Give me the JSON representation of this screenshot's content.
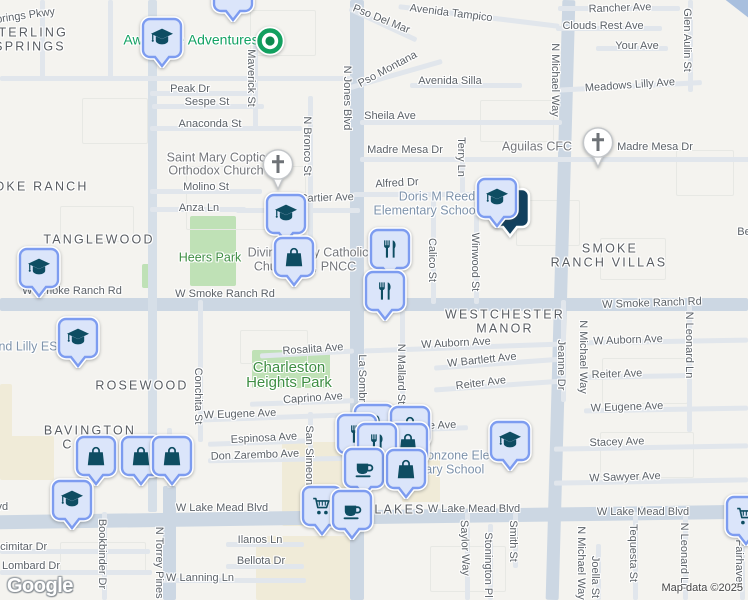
{
  "attribution": "Map data ©2025",
  "logo_text": "Google",
  "colors": {
    "background": "#f4f3ef",
    "major_road": "#ccd7e3",
    "minor_road": "#e1e6ec",
    "highway": "#a8bfde",
    "park_fill": "#bfe1b6",
    "commercial_fill": "#f0ebd8",
    "pin_fill": "#dbe5fa",
    "pin_border": "#7d9cf0",
    "pin_icon": "#0e4d62",
    "park_label": "#3e8e43",
    "school_label": "#7e93ab",
    "street_label": "#5c6268",
    "green_dot": "#12a05f"
  },
  "areas": [
    [
      "park",
      190,
      216,
      46,
      70
    ],
    [
      "park",
      142,
      264,
      10,
      24
    ],
    [
      "park",
      252,
      350,
      78,
      38
    ],
    [
      "com",
      0,
      436,
      54,
      44
    ],
    [
      "com",
      282,
      442,
      90,
      84
    ],
    [
      "com",
      256,
      536,
      108,
      64
    ],
    [
      "com",
      402,
      454,
      38,
      48
    ],
    [
      "com",
      0,
      384,
      12,
      56
    ],
    [
      "blk",
      186,
      166,
      118,
      62
    ],
    [
      "blk",
      60,
      206,
      72,
      34
    ],
    [
      "blk",
      480,
      100,
      72,
      40
    ],
    [
      "blk",
      250,
      10,
      64,
      44
    ],
    [
      "blk",
      602,
      358,
      84,
      44
    ],
    [
      "blk",
      600,
      432,
      92,
      44
    ],
    [
      "blk",
      240,
      330,
      66,
      32
    ],
    [
      "blk",
      430,
      546,
      74,
      44
    ],
    [
      "blk",
      60,
      542,
      84,
      30
    ],
    [
      "blk",
      676,
      150,
      56,
      44
    ],
    [
      "blk",
      516,
      200,
      62,
      44
    ],
    [
      "blk",
      600,
      238,
      64,
      40
    ],
    [
      "blk",
      82,
      98,
      64,
      44
    ]
  ],
  "roads": [
    [
      "M",
      350,
      0,
      14,
      600,
      0
    ],
    [
      "M",
      0,
      298,
      748,
      13,
      0
    ],
    [
      "M",
      -8,
      510,
      764,
      14,
      -0.8
    ],
    [
      "M",
      554,
      0,
      13,
      600,
      1.6
    ],
    [
      "M",
      163,
      486,
      13,
      114,
      0
    ],
    [
      "d",
      148,
      0,
      9,
      512,
      0
    ],
    [
      "h",
      672,
      -16,
      110,
      15,
      38
    ],
    [
      "m",
      0,
      76,
      352,
      5,
      0
    ],
    [
      "m",
      150,
      91,
      102,
      5,
      0
    ],
    [
      "m",
      152,
      104,
      112,
      5,
      0
    ],
    [
      "m",
      150,
      126,
      152,
      5,
      0
    ],
    [
      "m",
      558,
      6,
      122,
      5,
      0
    ],
    [
      "m",
      556,
      26,
      106,
      5,
      0
    ],
    [
      "m",
      596,
      46,
      72,
      5,
      0
    ],
    [
      "m",
      552,
      84,
      150,
      5,
      -3
    ],
    [
      "m",
      398,
      14,
      162,
      5,
      7
    ],
    [
      "m",
      346,
      22,
      74,
      5,
      25
    ],
    [
      "m",
      348,
      72,
      96,
      5,
      -16
    ],
    [
      "m",
      410,
      83,
      112,
      5,
      0
    ],
    [
      "m",
      360,
      120,
      202,
      5,
      0
    ],
    [
      "m",
      360,
      157,
      390,
      5,
      0
    ],
    [
      "m",
      353,
      192,
      172,
      5,
      0
    ],
    [
      "m",
      150,
      189,
      112,
      5,
      0
    ],
    [
      "m",
      150,
      207,
      96,
      5,
      0
    ],
    [
      "m",
      236,
      208,
      124,
      5,
      0
    ],
    [
      "m",
      260,
      351,
      94,
      5,
      -3
    ],
    [
      "m",
      250,
      400,
      104,
      5,
      -2
    ],
    [
      "m",
      364,
      345,
      198,
      5,
      -2
    ],
    [
      "m",
      584,
      339,
      164,
      5,
      -1
    ],
    [
      "m",
      434,
      361,
      132,
      5,
      -4
    ],
    [
      "m",
      434,
      383,
      130,
      5,
      -4
    ],
    [
      "m",
      584,
      374,
      102,
      5,
      -1
    ],
    [
      "m",
      194,
      415,
      158,
      5,
      -2
    ],
    [
      "m",
      364,
      427,
      104,
      5,
      -2
    ],
    [
      "m",
      584,
      407,
      164,
      5,
      -1
    ],
    [
      "m",
      208,
      440,
      104,
      5,
      -2
    ],
    [
      "m",
      208,
      457,
      146,
      5,
      -1
    ],
    [
      "m",
      554,
      445,
      194,
      5,
      -1
    ],
    [
      "m",
      554,
      479,
      194,
      5,
      -1
    ],
    [
      "m",
      226,
      542,
      78,
      5,
      0
    ],
    [
      "m",
      226,
      564,
      78,
      5,
      0
    ],
    [
      "m",
      0,
      549,
      150,
      5,
      0
    ],
    [
      "m",
      0,
      570,
      152,
      5,
      0
    ],
    [
      "m",
      158,
      578,
      148,
      5,
      0
    ],
    [
      "m",
      253,
      36,
      5,
      94,
      0
    ],
    [
      "m",
      308,
      96,
      5,
      146,
      0
    ],
    [
      "m",
      688,
      0,
      5,
      92,
      0
    ],
    [
      "m",
      460,
      140,
      5,
      58,
      0
    ],
    [
      "m",
      431,
      194,
      5,
      110,
      0
    ],
    [
      "m",
      474,
      194,
      5,
      110,
      0
    ],
    [
      "m",
      198,
      300,
      5,
      142,
      0
    ],
    [
      "m",
      400,
      300,
      5,
      132,
      0
    ],
    [
      "m",
      308,
      412,
      5,
      100,
      0
    ],
    [
      "m",
      561,
      300,
      5,
      102,
      0
    ],
    [
      "m",
      687,
      300,
      5,
      132,
      0
    ],
    [
      "m",
      683,
      512,
      5,
      88,
      0
    ],
    [
      "m",
      465,
      512,
      5,
      88,
      0
    ],
    [
      "m",
      488,
      524,
      5,
      76,
      0
    ],
    [
      "m",
      513,
      512,
      5,
      56,
      0
    ],
    [
      "m",
      633,
      512,
      5,
      88,
      0
    ],
    [
      "m",
      596,
      544,
      5,
      56,
      0
    ],
    [
      "m",
      102,
      512,
      5,
      88,
      0
    ],
    [
      "m",
      740,
      516,
      5,
      84,
      0
    ],
    [
      "m",
      167,
      428,
      5,
      60,
      0
    ],
    [
      "m",
      108,
      0,
      5,
      78,
      0
    ],
    [
      "m",
      40,
      0,
      5,
      78,
      0
    ]
  ],
  "labels": [
    [
      "st",
      "Springs Pkwy",
      22,
      17,
      -8
    ],
    [
      "st",
      "Pso Del Mar",
      381,
      20,
      22
    ],
    [
      "st",
      "Avenida Tampico",
      451,
      14,
      7
    ],
    [
      "st",
      "Rancher Ave",
      620,
      9,
      -2
    ],
    [
      "st",
      "Clouds Rest Ave",
      603,
      27,
      0
    ],
    [
      "st",
      "Your Ave",
      637,
      47,
      0
    ],
    [
      "st",
      "Glen Aulin St",
      686,
      40,
      90
    ],
    [
      "st",
      "Meadows Lilly Ave",
      630,
      86,
      -4
    ],
    [
      "st",
      "Maverick St",
      250,
      78,
      90
    ],
    [
      "st",
      "Peak Dr",
      190,
      90,
      0
    ],
    [
      "st",
      "Sespe St",
      207,
      103,
      0
    ],
    [
      "st",
      "Anaconda St",
      210,
      125,
      0
    ],
    [
      "st",
      "N Jones Blvd",
      346,
      98,
      90
    ],
    [
      "st",
      "Pso Montana",
      388,
      70,
      -28
    ],
    [
      "st",
      "Avenida Silla",
      450,
      82,
      0
    ],
    [
      "st",
      "Sheila Ave",
      390,
      117,
      0
    ],
    [
      "st",
      "N Bronco St",
      306,
      146,
      90
    ],
    [
      "st",
      "Madre Mesa Dr",
      405,
      151,
      0
    ],
    [
      "st",
      "Madre Mesa Dr",
      655,
      148,
      0
    ],
    [
      "st",
      "Terry Ln",
      460,
      157,
      90
    ],
    [
      "st",
      "Alfred Dr",
      397,
      184,
      -3
    ],
    [
      "st",
      "N Michael Way",
      554,
      80,
      90
    ],
    [
      "st",
      "W Cartier Ave",
      320,
      199,
      -2
    ],
    [
      "st",
      "Molino St",
      206,
      188,
      0
    ],
    [
      "st",
      "Anza Ln",
      199,
      209,
      0
    ],
    [
      "st",
      "Calico St",
      431,
      260,
      90
    ],
    [
      "st",
      "Winwood St",
      474,
      262,
      90
    ],
    [
      "st",
      "W Smoke Ranch Rd",
      72,
      292,
      0
    ],
    [
      "st",
      "W Smoke Ranch Rd",
      225,
      295,
      0
    ],
    [
      "st",
      "W Smoke Ranch Rd",
      652,
      304,
      -2
    ],
    [
      "st",
      "W Auborn Ave",
      456,
      344,
      -3
    ],
    [
      "st",
      "W Bartlett Ave",
      482,
      361,
      -6
    ],
    [
      "st",
      "Reiter Ave",
      481,
      384,
      -7
    ],
    [
      "st",
      "Jeanne Dr",
      560,
      365,
      90
    ],
    [
      "st",
      "N Michael Way",
      582,
      357,
      90
    ],
    [
      "st",
      "N Leonard Ln",
      688,
      345,
      90
    ],
    [
      "st",
      "W Auborn Ave",
      628,
      341,
      -2
    ],
    [
      "st",
      "Reiter Ave",
      617,
      375,
      -2
    ],
    [
      "st",
      "W Eugene Ave",
      627,
      408,
      -2
    ],
    [
      "st",
      "Rosalita Ave",
      313,
      350,
      -4
    ],
    [
      "st",
      "Caprino Ave",
      313,
      399,
      -4
    ],
    [
      "st",
      "La Sombra St",
      361,
      388,
      90
    ],
    [
      "st",
      "N Mallard St",
      400,
      374,
      90
    ],
    [
      "st",
      "W Eugene Ave",
      240,
      415,
      -2
    ],
    [
      "st",
      "W Eugene Ave",
      420,
      427,
      -2
    ],
    [
      "st",
      "Espinosa Ave",
      264,
      439,
      -3
    ],
    [
      "st",
      "Don Zarembo Ave",
      255,
      456,
      -2
    ],
    [
      "st",
      "San Simeon St",
      308,
      462,
      90
    ],
    [
      "st",
      "Conchita St",
      197,
      396,
      90
    ],
    [
      "st",
      "Stacey Ave",
      617,
      443,
      -2
    ],
    [
      "st",
      "W Sawyer Ave",
      625,
      478,
      -2
    ],
    [
      "st",
      "W Lake Mead Blvd",
      -38,
      508,
      0
    ],
    [
      "st",
      "W Lake Mead Blvd",
      222,
      509,
      0
    ],
    [
      "st",
      "W Lake Mead Blvd",
      474,
      510,
      0
    ],
    [
      "st",
      "W Lake Mead Blvd",
      643,
      513,
      0
    ],
    [
      "st",
      "Saylor Way",
      464,
      548,
      88
    ],
    [
      "st",
      "Stonington Pl",
      487,
      565,
      90
    ],
    [
      "st",
      "Smith St",
      512,
      541,
      90
    ],
    [
      "st",
      "N Michael Way",
      580,
      563,
      90
    ],
    [
      "st",
      "Joella St",
      594,
      577,
      90
    ],
    [
      "st",
      "Tequesta St",
      632,
      553,
      90
    ],
    [
      "st",
      "N Leonard Ln",
      683,
      556,
      90
    ],
    [
      "st",
      "Fairhaven",
      738,
      564,
      90
    ],
    [
      "st",
      "N Torrey Pines Dr",
      158,
      570,
      90
    ],
    [
      "st",
      "Bookbinder Dr",
      101,
      554,
      90
    ],
    [
      "st",
      "Scimitar Dr",
      20,
      548,
      0
    ],
    [
      "st",
      "Lombard Dr",
      31,
      567,
      0
    ],
    [
      "st",
      "W Lanning Ln",
      200,
      579,
      0
    ],
    [
      "st",
      "Ilanos Ln",
      260,
      541,
      0
    ],
    [
      "st",
      "Bellota Dr",
      261,
      562,
      0
    ],
    [
      "st",
      "Be",
      744,
      233,
      0
    ],
    [
      "area",
      "STERLING",
      28,
      33,
      0
    ],
    [
      "area",
      "SPRINGS",
      30,
      47,
      0
    ],
    [
      "area",
      "SMOKE RANCH",
      30,
      187,
      0
    ],
    [
      "area",
      "TANGLEWOOD",
      99,
      240,
      0
    ],
    [
      "area",
      "SMOKE",
      610,
      249,
      0
    ],
    [
      "area",
      "RANCH VILLAS",
      609,
      263,
      0
    ],
    [
      "area",
      "WESTCHESTER",
      505,
      315,
      0
    ],
    [
      "area",
      "MANOR",
      505,
      329,
      0
    ],
    [
      "area",
      "ROSEWOOD",
      142,
      386,
      0
    ],
    [
      "area",
      "BAVINGTON",
      90,
      431,
      0
    ],
    [
      "area",
      "C",
      68,
      445,
      0
    ],
    [
      "area",
      "LAKES",
      400,
      510,
      0
    ],
    [
      "poig",
      "Saint Mary Coptic",
      216,
      158,
      0
    ],
    [
      "poig",
      "Orthodox Church",
      216,
      171,
      0
    ],
    [
      "poig",
      "Aguilas CFC",
      537,
      147,
      0
    ],
    [
      "poi",
      "Doris M Reed",
      437,
      197,
      0
    ],
    [
      "poi",
      "Elementary School",
      426,
      211,
      0
    ],
    [
      "poig",
      "Divine Mercy Catholic",
      308,
      253,
      0
    ],
    [
      "poig",
      "Church NV, PNCC",
      305,
      267,
      0
    ],
    [
      "poi",
      "nd Lilly ES",
      28,
      347,
      0
    ],
    [
      "poi",
      "Ronzone Elemen",
      466,
      456,
      0
    ],
    [
      "poi",
      "tary School",
      453,
      470,
      0
    ],
    [
      "park",
      "Heers Park",
      210,
      258,
      0
    ],
    [
      "parklg",
      "Charleston",
      289,
      368,
      0
    ],
    [
      "parklg",
      "Heights Park",
      289,
      383,
      0
    ],
    [
      "poigrn",
      "Awesome Adventures",
      191,
      40,
      0
    ]
  ],
  "pins": [
    [
      "dark",
      488,
      186
    ],
    [
      "grad",
      475,
      176
    ],
    [
      "grad",
      140,
      16
    ],
    [
      "grad",
      211,
      -30
    ],
    [
      "gdot",
      254,
      25
    ],
    [
      "church",
      258,
      146
    ],
    [
      "church",
      578,
      124
    ],
    [
      "grad",
      264,
      192
    ],
    [
      "bag",
      272,
      235
    ],
    [
      "fork",
      368,
      227
    ],
    [
      "fork",
      363,
      269
    ],
    [
      "grad",
      17,
      246
    ],
    [
      "grad",
      56,
      316
    ],
    [
      "grad",
      488,
      419
    ],
    [
      "fork",
      352,
      402
    ],
    [
      "bag",
      388,
      404
    ],
    [
      "fork",
      335,
      412
    ],
    [
      "bag",
      386,
      421
    ],
    [
      "fork",
      355,
      421
    ],
    [
      "coffee",
      342,
      446
    ],
    [
      "bag",
      384,
      447
    ],
    [
      "cart",
      300,
      484
    ],
    [
      "coffee",
      330,
      488
    ],
    [
      "bag",
      74,
      434
    ],
    [
      "bag",
      119,
      434
    ],
    [
      "bag",
      150,
      434
    ],
    [
      "grad",
      50,
      478
    ],
    [
      "cart",
      724,
      494
    ]
  ]
}
